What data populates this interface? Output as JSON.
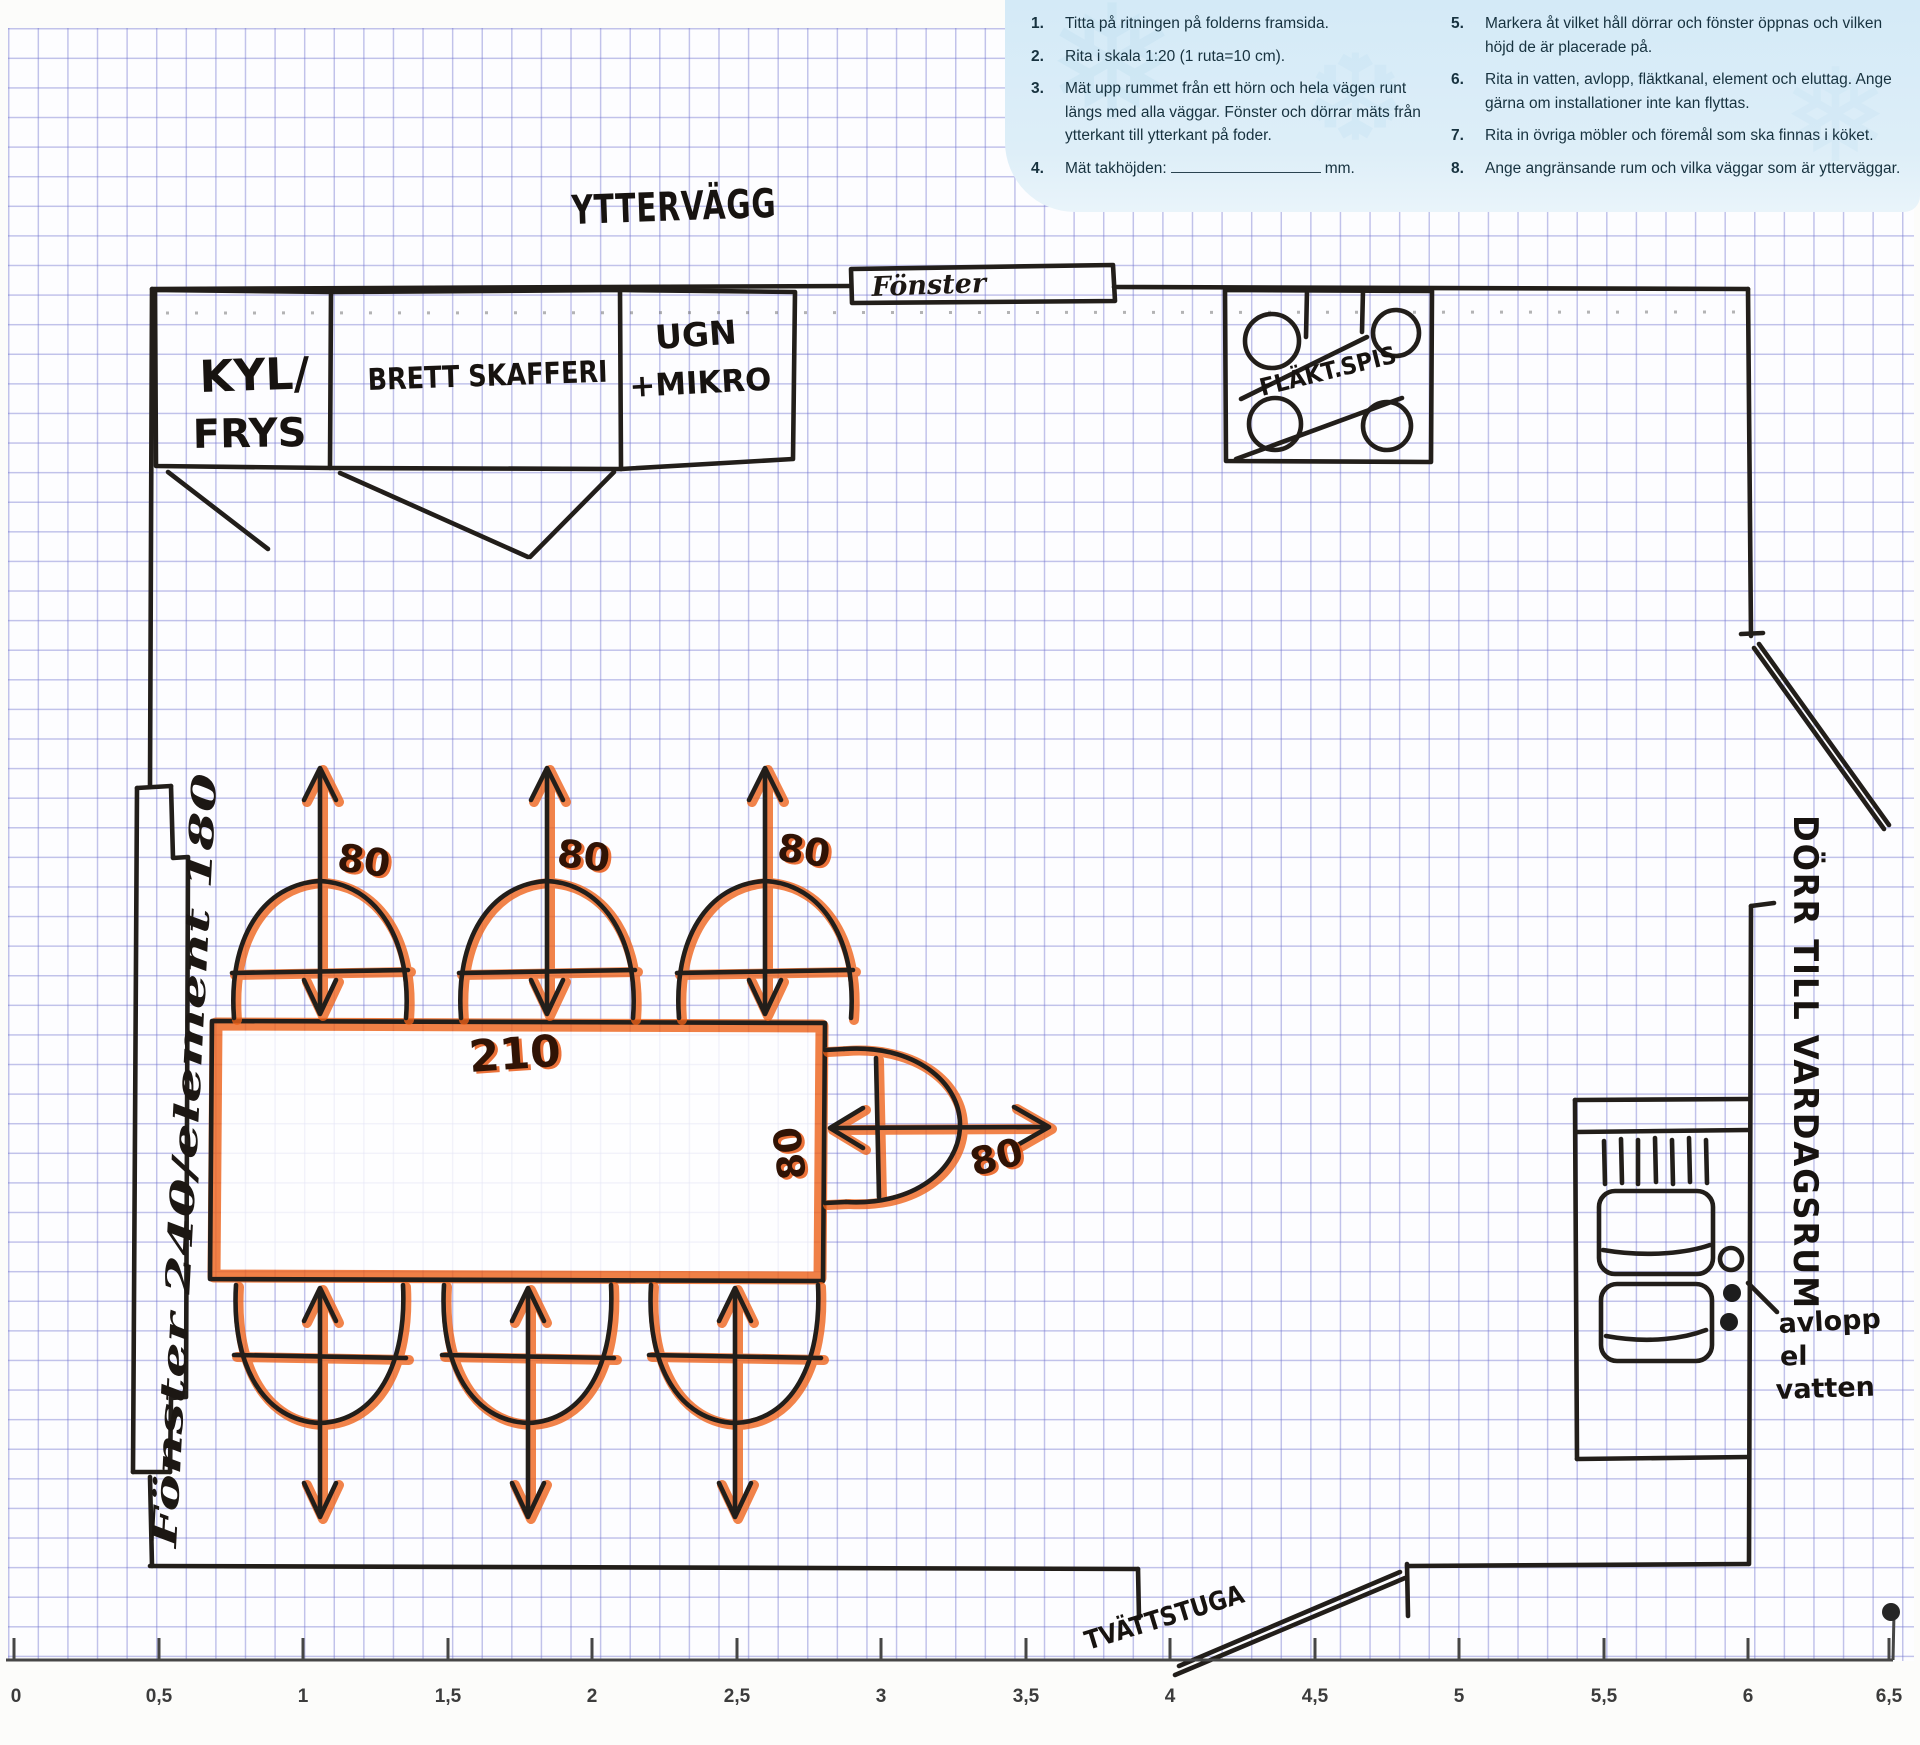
{
  "instructions": {
    "left": [
      {
        "num": "1.",
        "text": "Titta på ritningen på folderns framsida."
      },
      {
        "num": "2.",
        "text": "Rita i skala 1:20 (1 ruta=10 cm)."
      },
      {
        "num": "3.",
        "text": "Mät upp rummet från ett hörn och hela vägen runt längs med alla väggar. Fönster och dörrar mäts från ytterkant till ytterkant på foder."
      },
      {
        "num": "4.",
        "text": "Mät takhöjden:",
        "suffix": "mm."
      }
    ],
    "right": [
      {
        "num": "5.",
        "text": "Markera åt vilket håll dörrar och fönster öppnas och vilken höjd de är placerade på."
      },
      {
        "num": "6.",
        "text": "Rita in vatten, avlopp, fläktkanal, element och eluttag. Ange gärna om installationer inte kan flyttas."
      },
      {
        "num": "7.",
        "text": "Rita in övriga möbler och föremål som ska finnas i köket."
      },
      {
        "num": "8.",
        "text": "Ange angränsande rum och vilka väggar som är ytterväggar."
      }
    ]
  },
  "plan": {
    "outer_wall_label": "YTTERVÄGG",
    "fridge_label_line1": "KYL/",
    "fridge_label_line2": "FRYS",
    "pantry_label": "BRETT SKAFFERI",
    "oven_label_line1": "UGN",
    "oven_label_line2": "+MIKRO",
    "stove_label": "FLÄKT.SPIS",
    "window_top_label": "Fönster",
    "window_left_label": "Fönster 240/element 180",
    "door_living_room_label": "DÖRR TILL VARDAGSRUM",
    "laundry_label": "TVÄTTSTUGA",
    "utility_label_line1": "avlopp",
    "utility_label_line2": "el",
    "utility_label_line3": "vatten",
    "table_length_cm": "210",
    "chair_width_cm": "80"
  },
  "ruler": {
    "labels": [
      "0",
      "0,5",
      "1",
      "1,5",
      "2",
      "2,5",
      "3",
      "3,5",
      "4",
      "4,5",
      "5",
      "5,5",
      "6",
      "6,5"
    ]
  },
  "colors": {
    "marker": "#ee6118",
    "ink": "#221e1a",
    "grid_line": "#8c8fd0",
    "panel_blue": "#d9ecf7"
  }
}
